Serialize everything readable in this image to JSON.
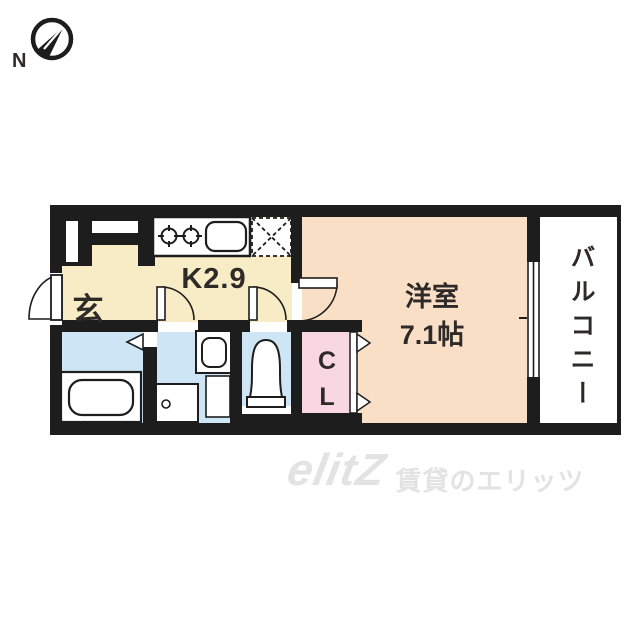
{
  "compass": {
    "label": "N"
  },
  "rooms": {
    "genkan": {
      "label": "玄"
    },
    "kitchen": {
      "label": "K2.9"
    },
    "living": {
      "label": "洋室",
      "size": "7.1帖"
    },
    "balcony": {
      "label": "バルコニー"
    },
    "closet": {
      "letters": [
        "C",
        "L"
      ]
    }
  },
  "watermark": {
    "logo": "elitZ",
    "text": "賃貸のエリッツ"
  },
  "colors": {
    "wall": "#1d1d1d",
    "cream": "#f7ecc5",
    "peach": "#fadfc7",
    "pink": "#f8d6e2",
    "blue": "#cde5f4",
    "text": "#2e2a28",
    "watermark": "#e3e3e3"
  }
}
